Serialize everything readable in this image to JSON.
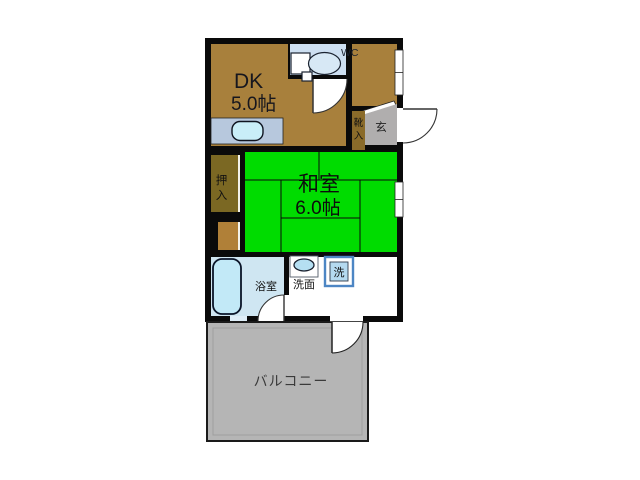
{
  "floorplan": {
    "title": "1DK floor plan",
    "rooms": {
      "dk": {
        "name": "DK",
        "size": "5.0帖"
      },
      "washitsu": {
        "name": "和室",
        "size": "6.0帖"
      },
      "wc": {
        "label": "WC"
      },
      "bath": {
        "label": "浴室"
      },
      "washroom": {
        "label": "洗面"
      },
      "washer": {
        "label": "洗"
      },
      "genkan": {
        "label": "玄"
      },
      "shoe_box": {
        "char1": "靴",
        "char2": "入"
      },
      "oshiire": {
        "char1": "押",
        "char2": "入"
      },
      "balcony": {
        "label": "バルコニー"
      }
    },
    "colors": {
      "wall": "#0a0a0a",
      "dk_brown": "#a8803c",
      "oshiire_olive": "#7b6823",
      "oshiire_lower": "#b08038",
      "shoe_brown": "#8a6b2a",
      "tatami_green": "#00dc00",
      "wc_bg": "#cddff1",
      "bath_bg": "#cfe6f2",
      "tub_fill": "#c2e9f7",
      "counter": "#b7c8dd",
      "counter_sink": "#c9eef8",
      "sink_oval": "#b5dff2",
      "washer_border": "#4d86c4",
      "washer_fill": "#b5daf0",
      "genkan_grey": "#b0aeae",
      "balcony_grey": "#b5b5b5",
      "text_dark": "#16161e"
    }
  }
}
